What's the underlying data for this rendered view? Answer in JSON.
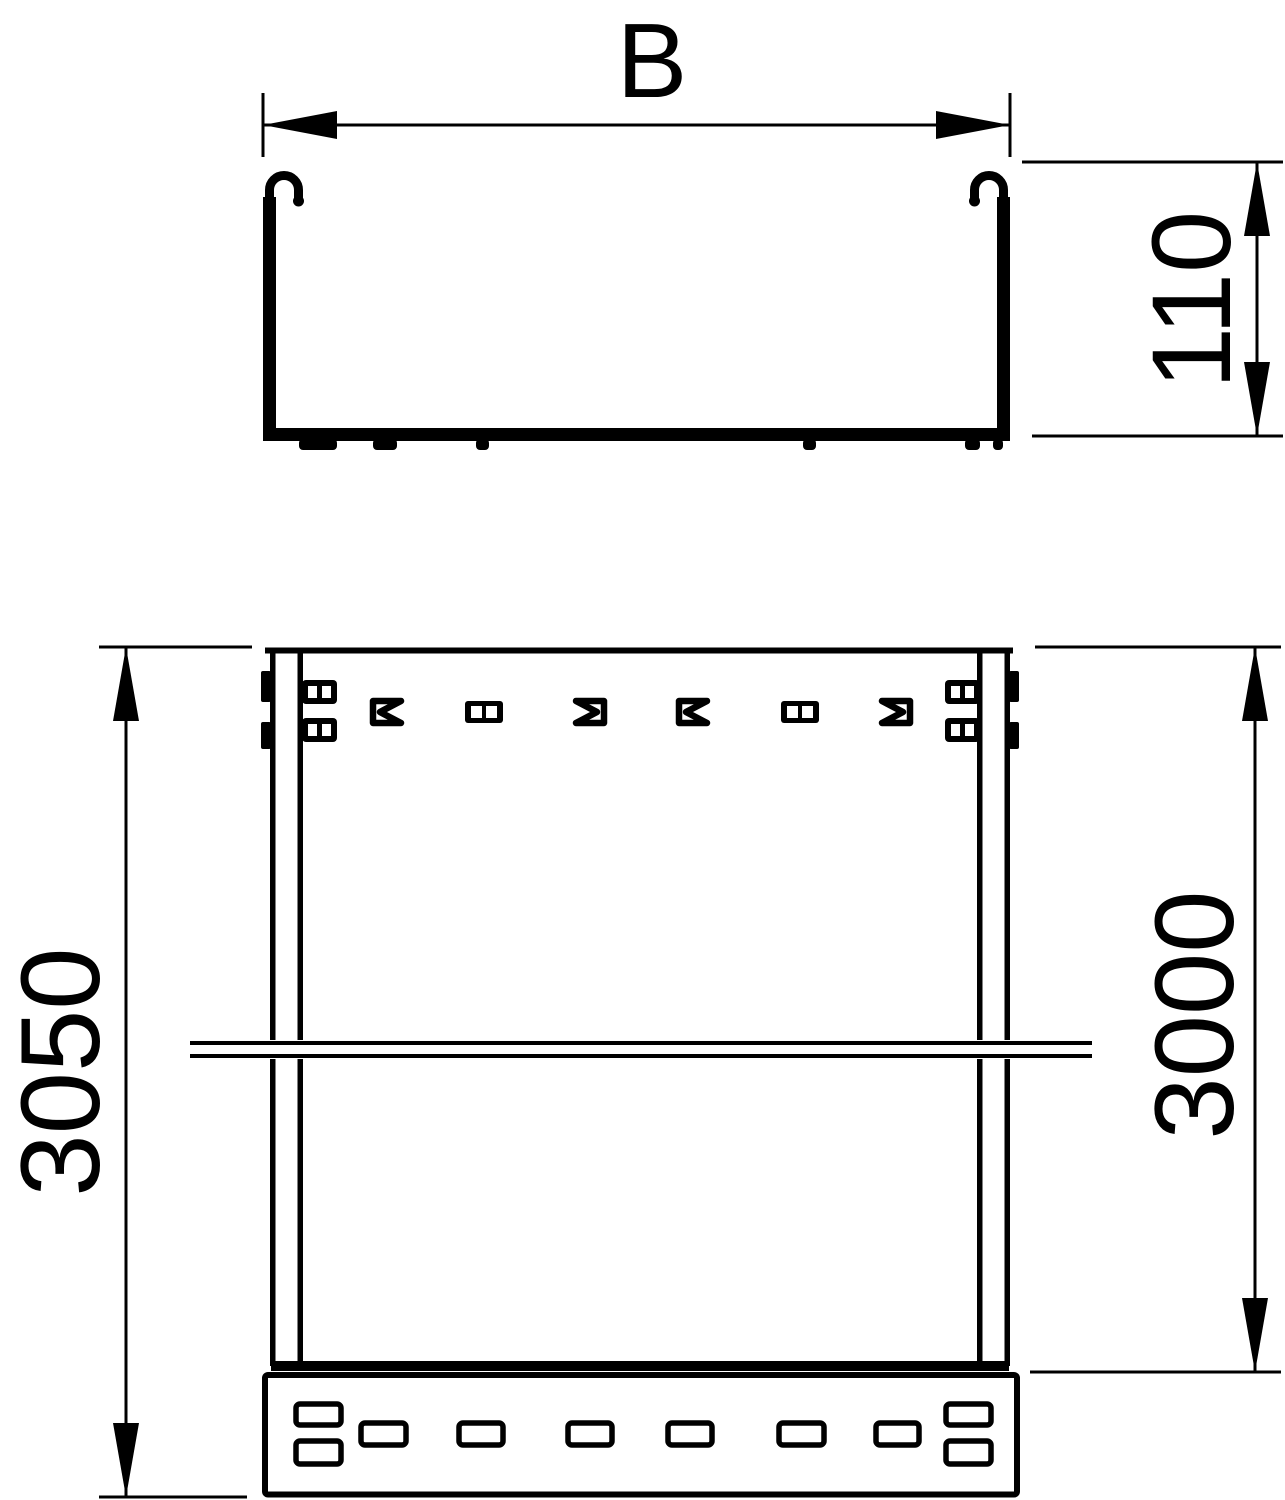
{
  "drawing": {
    "dimensions": {
      "width_label": "B",
      "height_mm": "110",
      "overall_length_mm": "3050",
      "section_length_mm": "3000"
    },
    "colors": {
      "ink": "#000000",
      "background": "#ffffff"
    }
  }
}
